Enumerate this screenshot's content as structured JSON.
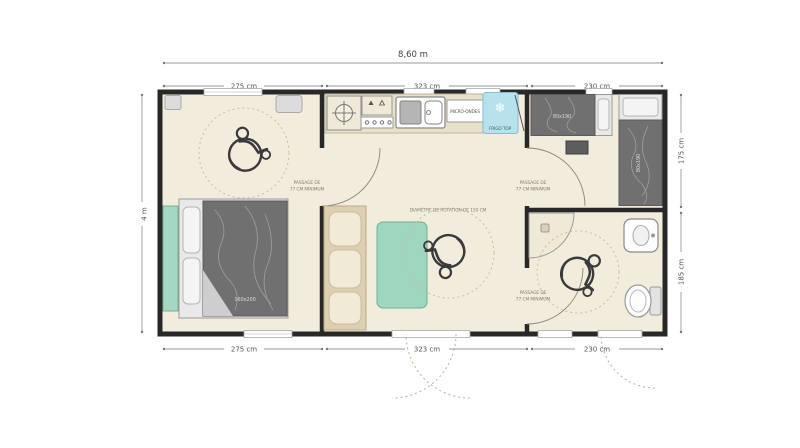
{
  "plan": {
    "overall_width_label": "8,60 m",
    "overall_depth_label": "4 m",
    "top_segments": [
      "275 cm",
      "323 cm",
      "230 cm"
    ],
    "bottom_segments": [
      "275 cm",
      "323 cm",
      "230 cm"
    ],
    "right_segments": [
      "175 cm",
      "185 cm"
    ]
  },
  "kitchen": {
    "microwave_label": "MICRO-ONDES",
    "fridge_label": "FRIGO TOP",
    "snowflake_glyph": "❄"
  },
  "accessibility": {
    "rotation_note": "DIAMÈTRE DE ROTATION DE 150 CM",
    "passage_line1": "PASSAGE DE",
    "passage_line2": "77 CM MINIMUM"
  },
  "furniture": {
    "double_bed_size": "160x200",
    "single_bed_size": "80x190"
  },
  "colors": {
    "floor": "#f2ecdd",
    "wall": "#282828",
    "teal_furniture": "#a5d8c2",
    "fridge_blue": "#b6e2ee",
    "bed_duvet": "#707070",
    "counter_beige": "#e7e0cb",
    "cushion_cream": "#f1ead7",
    "dimension_gray": "#9a9a9a",
    "dotted_circle": "#c9c0a4"
  }
}
